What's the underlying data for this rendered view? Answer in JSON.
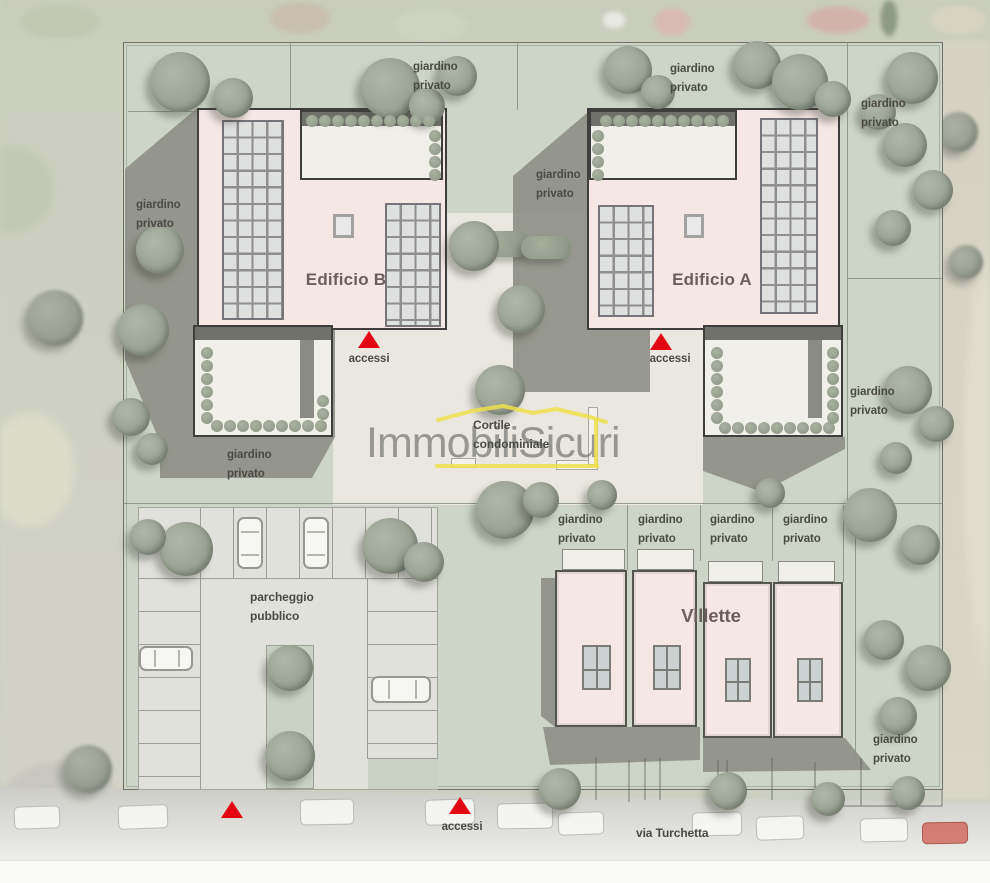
{
  "watermark": {
    "text": "ImmobiliSicuri"
  },
  "labels": {
    "giardino": "giardino",
    "privato": "privato",
    "edificio_b": "Edificio B",
    "edificio_a": "Edificio A",
    "villette": "Villette",
    "parcheggio_1": "parcheggio",
    "parcheggio_2": "pubblico",
    "cortile_1": "Cortile",
    "cortile_2": "condominiale",
    "accessi": "accessi",
    "street": "via Turchetta"
  },
  "colors": {
    "accent_red": "#e30613",
    "building_pink": "#f4e7e4",
    "site_green": "#ccd5c7",
    "courtyard_beige": "#e9e7e0",
    "shadow_gray": "#8f9088",
    "watermark_yellow": "#efe14b"
  },
  "icons": {
    "access_marker": "red-triangle",
    "tree": "round-canopy",
    "hedge": "bush-row",
    "car": "rounded-rect-top-view",
    "solar_panel": "grid-array",
    "skylight": "bordered-square",
    "window": "four-pane"
  }
}
